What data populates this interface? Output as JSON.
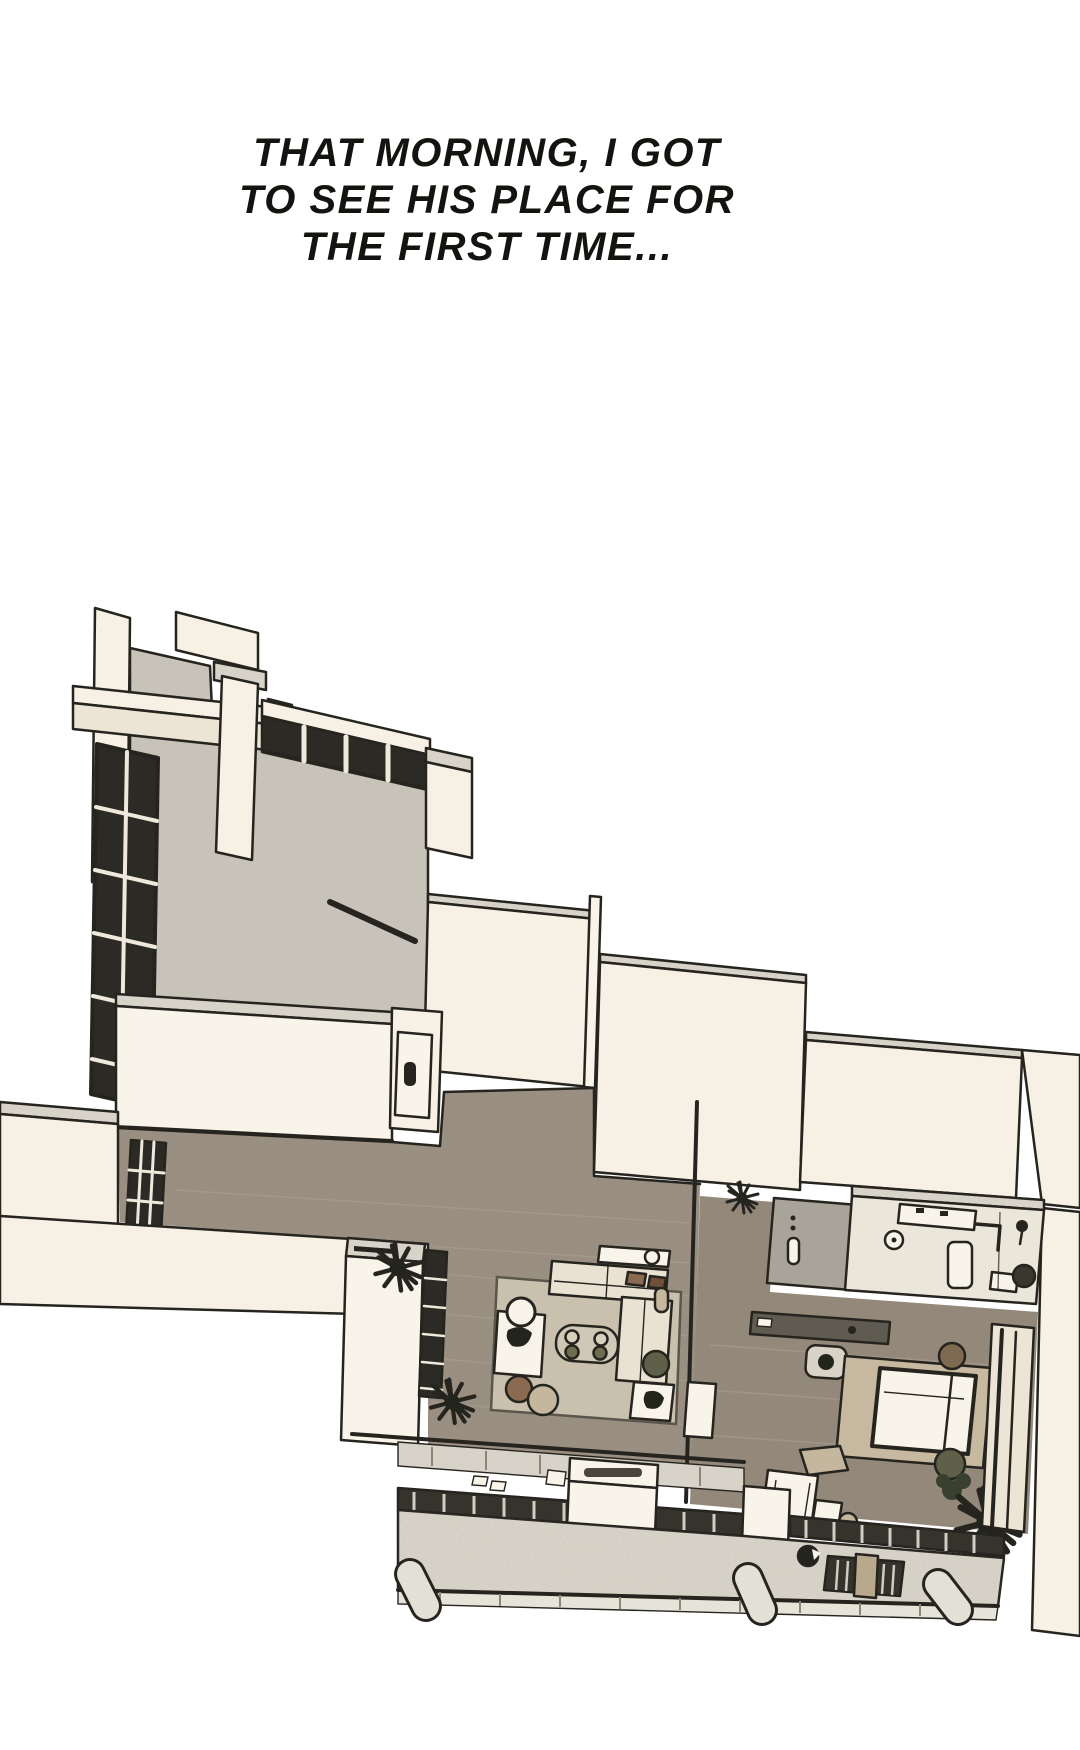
{
  "caption": {
    "line1": "THAT MORNING, I GOT",
    "line2": "TO SEE HIS PLACE FOR",
    "line3": "THE FIRST TIME..."
  },
  "palette": {
    "background": "#ffffff",
    "caption_ink": "#151310",
    "ink": "#26241f",
    "wall_cream": "#f7f1e5",
    "wall_cream_shade": "#ece4d4",
    "wall_cap": "#d7d3c8",
    "wall_gray": "#c7c3b8",
    "wall_gray_dark": "#a9a499",
    "window_dark": "#2b2a25",
    "pane_light": "#efe9dc",
    "floor_wood": "#9c9183",
    "floor_wood_dark": "#958a7b",
    "rug": "#c9c0ad",
    "rug_tan": "#c7b8a0",
    "tile": "#eae6da",
    "deck": "#dcd8cd",
    "deck_edge": "#e6e3d9",
    "furniture_white": "#f8f4ea",
    "sofa_cream": "#e9e1d1",
    "desk_gray": "#5f5b50",
    "rail_dark": "#35332c",
    "slat_light": "#cfccc2",
    "brown": "#8a6a50",
    "brown_dark": "#6d4f3a",
    "tan": "#c5b79e",
    "olive": "#60604a",
    "olive_light": "#6e6e4e",
    "stool_wood": "#7d6a50",
    "plant_dark": "#23251d",
    "leaf_green": "#3a4030"
  }
}
